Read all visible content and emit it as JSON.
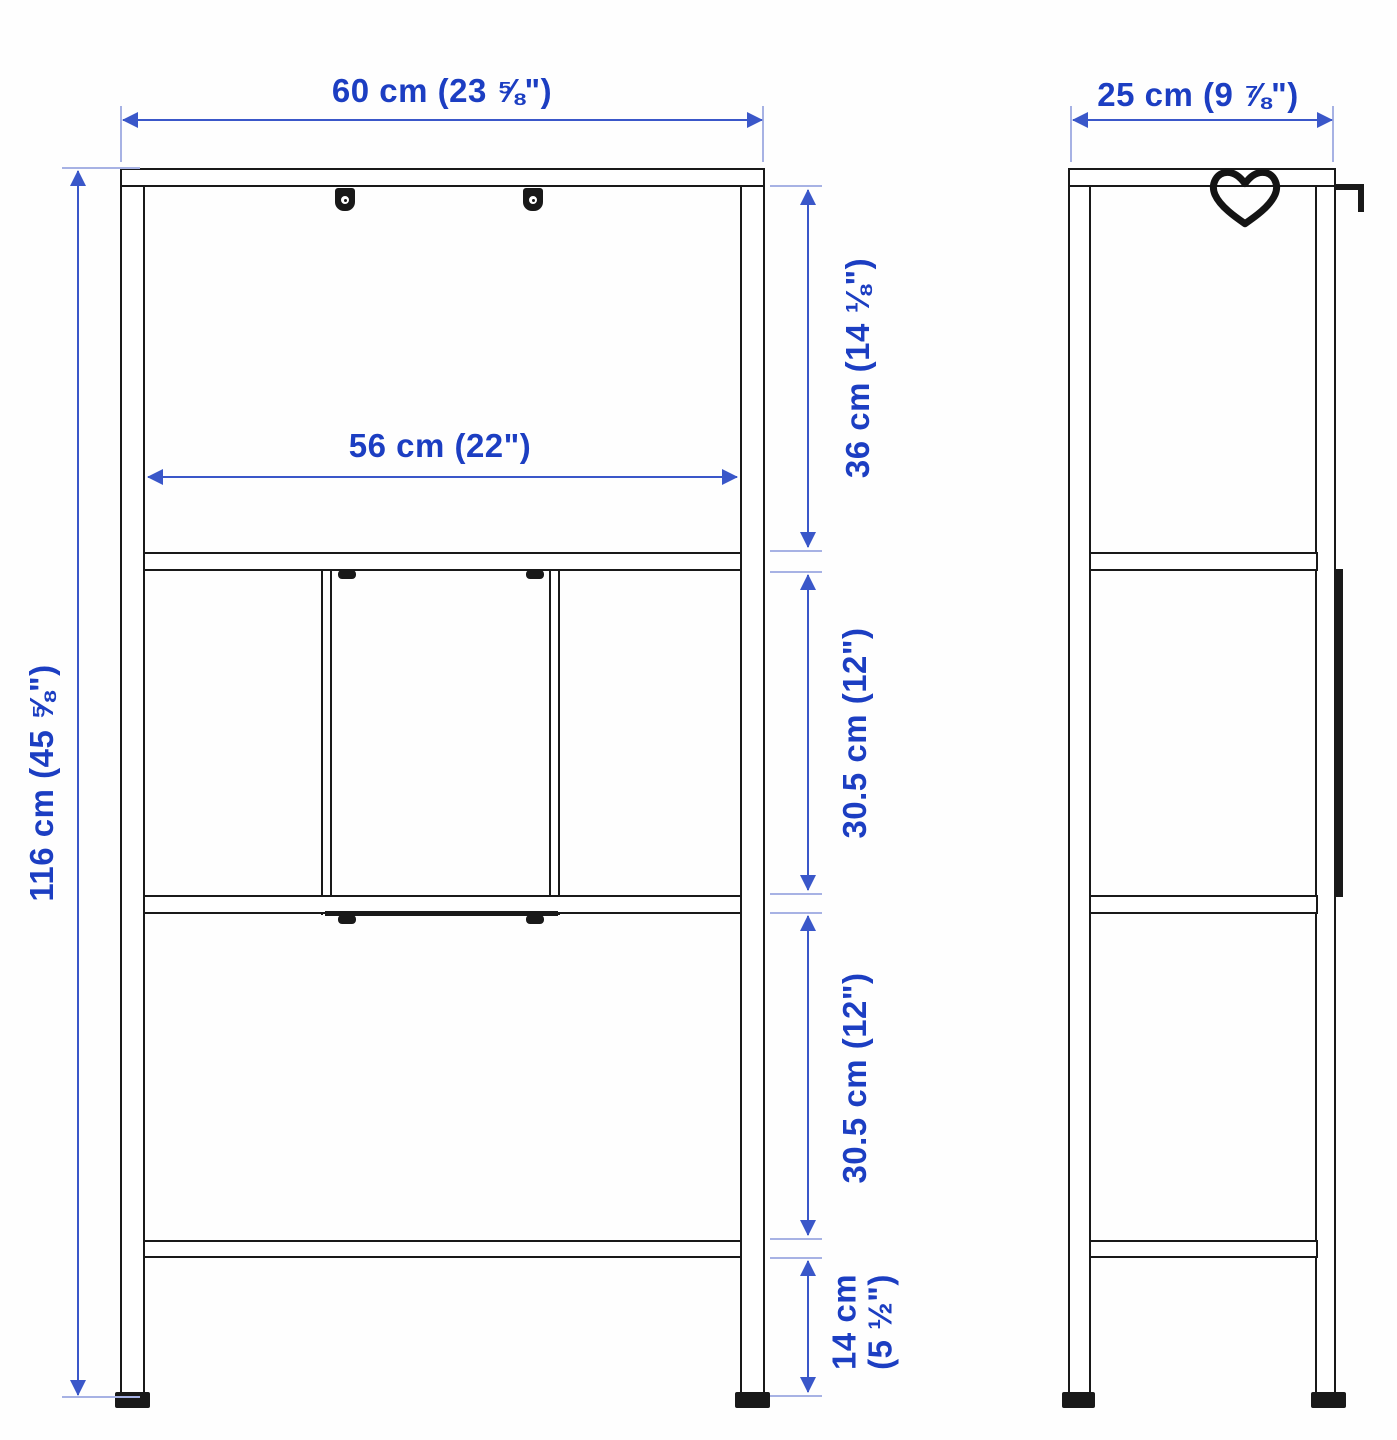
{
  "diagram": {
    "kind": "furniture-dimension-diagram",
    "colors": {
      "dimension_text": "#1c3ec2",
      "dimension_line": "#3a57c9",
      "tick_line": "#a7b2e4",
      "furniture_line": "#191919"
    },
    "front_view": {
      "total_width_label": "60 cm (23 ⅝\")",
      "inner_width_label": "56 cm (22\")",
      "total_height_label": "116 cm (45 ⅝\")",
      "top_section_label": "36 cm (14 ⅛\")",
      "middle_section_label": "30.5 cm (12\")",
      "lower_section_label": "30.5 cm (12\")",
      "base_section_label_line1": "14 cm",
      "base_section_label_line2": "(5 ½\")"
    },
    "side_view": {
      "total_depth_label": "25 cm (9 ⅞\")"
    },
    "icons": {
      "favorite": "heart-outline-icon"
    }
  }
}
